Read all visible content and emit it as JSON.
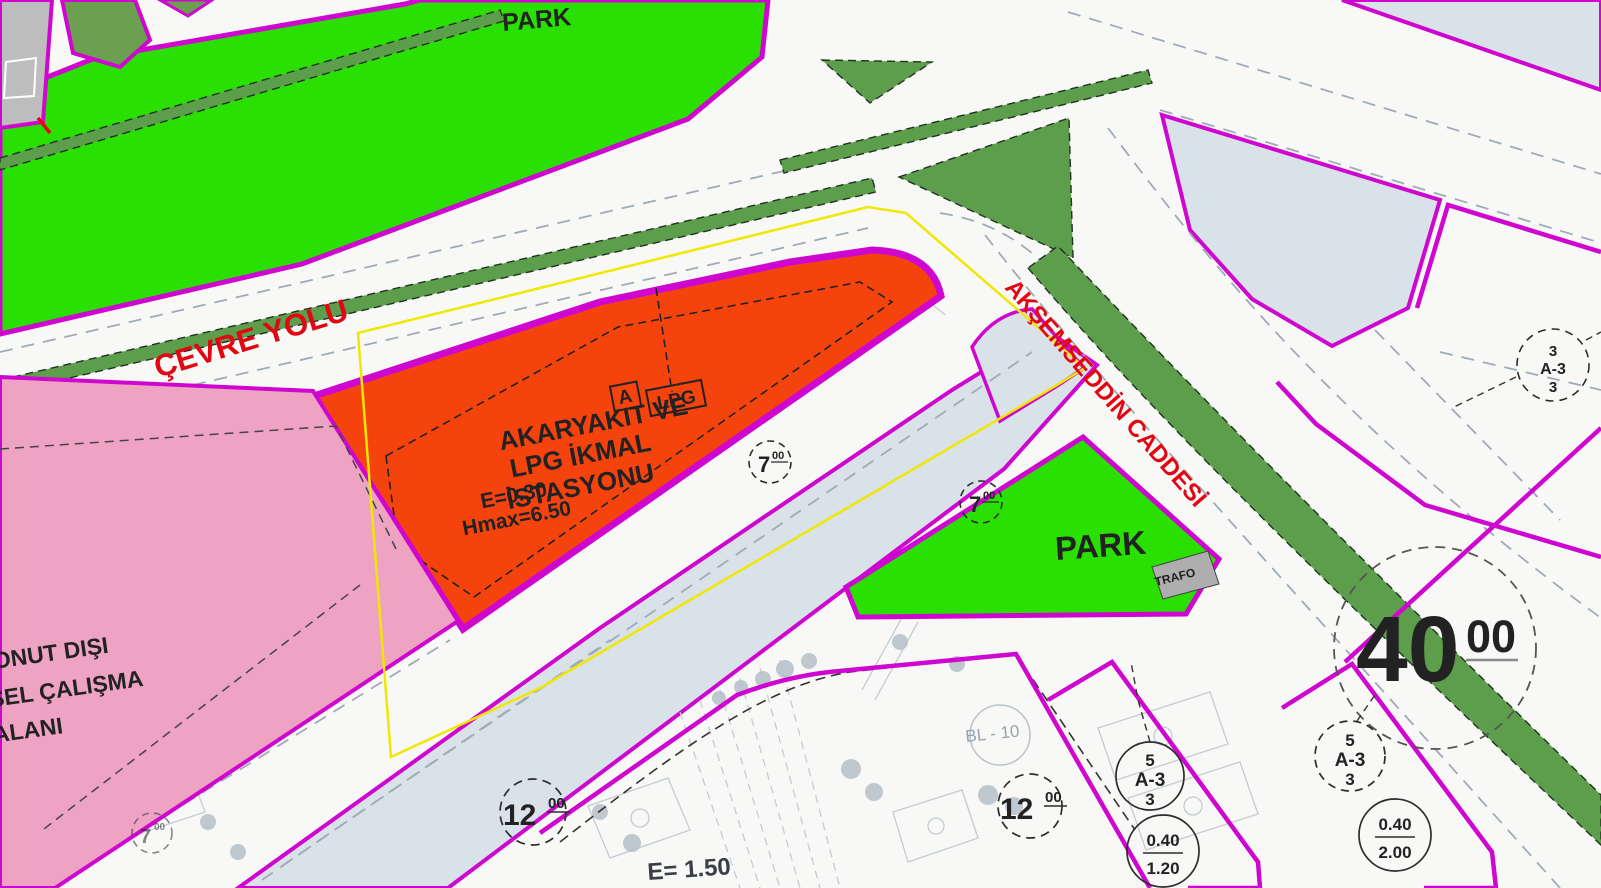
{
  "map_title": "imar plan map",
  "colors": {
    "park_green": "#29e000",
    "median_green": "#5c9e4b",
    "station_red": "#f5430e",
    "industrial_pink": "#efa3c2",
    "road_edge_magenta": "#cf06cf",
    "parcel_blue": "#d9e1e9",
    "boundary_yellow": "#f0e800",
    "label_red": "#e20613"
  },
  "roads": {
    "cevre_yolu": "ÇEVRE YOLU",
    "aksemseddin": "AKŞEMSEDDİN CADDESİ",
    "width_40": {
      "value": "40",
      "sup": "00"
    },
    "width_12": {
      "value": "12",
      "sup": "00"
    },
    "width_7": {
      "value": "7",
      "sup": "00"
    }
  },
  "areas": {
    "park_top": "PARK",
    "park_east": "PARK",
    "station": {
      "tag_a": "A",
      "tag_lpg": "LPG",
      "name_line1": "AKARYAKIT VE",
      "name_line2": "LPG İKMAL",
      "name_line3": "İSTASYONU",
      "emsal": "E=0.30",
      "hmax": "Hmax=6.50"
    },
    "industrial": {
      "line1": "ONUT DIŞI",
      "line2": "SEL ÇALIŞMA",
      "line3": "ALANI"
    },
    "trafo": "TRAFO",
    "bl10": "BL - 10",
    "e150": "E= 1.50"
  },
  "zoning": {
    "a3_solid": {
      "top": "5",
      "mid": "A-3",
      "bot": "3"
    },
    "a3_dashed": {
      "top": "5",
      "mid": "A-3",
      "bot": "3"
    },
    "a3_small": {
      "top": "3",
      "mid": "A-3",
      "bot": "3"
    },
    "ratio_120": {
      "num": "0.40",
      "den": "1.20"
    },
    "ratio_200": {
      "num": "0.40",
      "den": "2.00"
    }
  }
}
